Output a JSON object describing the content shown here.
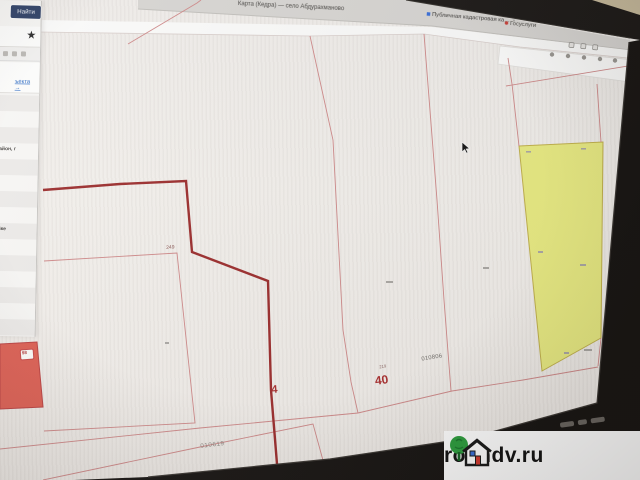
{
  "browser": {
    "window_title": "Карта (Кедра) — село Абдурахманово",
    "tabs": [
      {
        "label": "Публичная кадастровая ка…",
        "close": "×"
      },
      {
        "label": "Госуслуги"
      }
    ]
  },
  "pkk": {
    "search_button": "Найти",
    "favorite_icon": "★",
    "object_link": "ъекта →",
    "info_rows": [
      "айон, г",
      "йке"
    ]
  },
  "map": {
    "selected_parcel_number": "40",
    "selected_parcel_super": "219",
    "parcel_number_4": "4",
    "parcel_number_249": "249",
    "red_parcel_chip": "98",
    "quarter_code_right": "010806",
    "quarter_code_bottom": "010619",
    "colors": {
      "selected_outline": "#9c2e2e",
      "parcel_line": "#cf8a8a",
      "highlight_parcel_fill": "#e9eb83",
      "red_parcel_fill": "#de6054",
      "map_background": "#f1eeea"
    }
  },
  "watermark": {
    "site": "rosndv.ru"
  }
}
